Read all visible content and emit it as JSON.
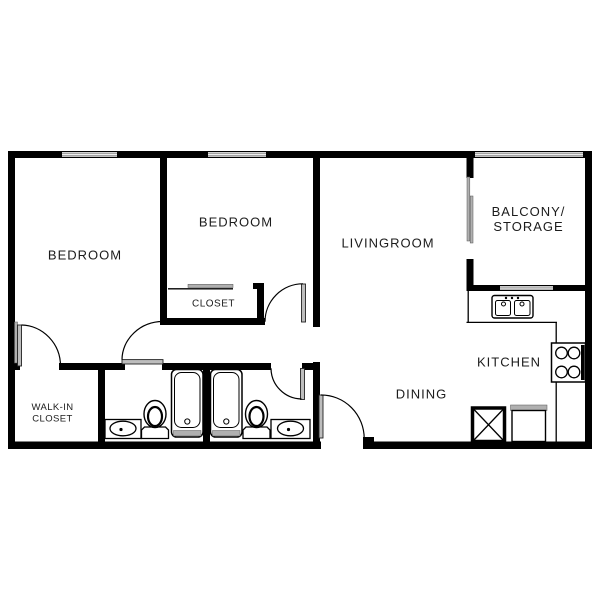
{
  "diagram_type": "apartment-floor-plan",
  "rooms": {
    "bedroom_left": {
      "label": "BEDROOM"
    },
    "bedroom_middle": {
      "label": "BEDROOM"
    },
    "bedroom_closet": {
      "label": "CLOSET"
    },
    "livingroom": {
      "label": "LIVINGROOM"
    },
    "balcony_storage": {
      "line1": "BALCONY/",
      "line2": "STORAGE"
    },
    "kitchen": {
      "label": "KITCHEN"
    },
    "dining": {
      "label": "DINING"
    },
    "walk_in_closet": {
      "line1": "WALK-IN",
      "line2": "CLOSET"
    }
  },
  "fixtures": {
    "kitchen": [
      "double-basin-sink",
      "stove-4-burner",
      "refrigerator",
      "water-heater-x-box"
    ],
    "bathroom_1": [
      "vanity-sink",
      "toilet",
      "bathtub"
    ],
    "bathroom_2": [
      "bathtub",
      "toilet",
      "vanity-sink"
    ],
    "balcony": [
      "sliding-glass-door"
    ],
    "windows": [
      "bedroom-left-window",
      "bedroom-middle-window",
      "balcony-window",
      "kitchen-window"
    ],
    "doors": [
      "walk-in-closet-door",
      "bathroom-1-door",
      "bedroom-middle-door",
      "bathroom-2-door",
      "dining-entry-door"
    ]
  },
  "colors": {
    "walls": "#000000",
    "windows": "#a3a3a3",
    "door_leaf": "#bdbdbd",
    "fixture_gray": "#b0b0b0",
    "labels": "#1c1c1c",
    "background": "#ffffff"
  }
}
